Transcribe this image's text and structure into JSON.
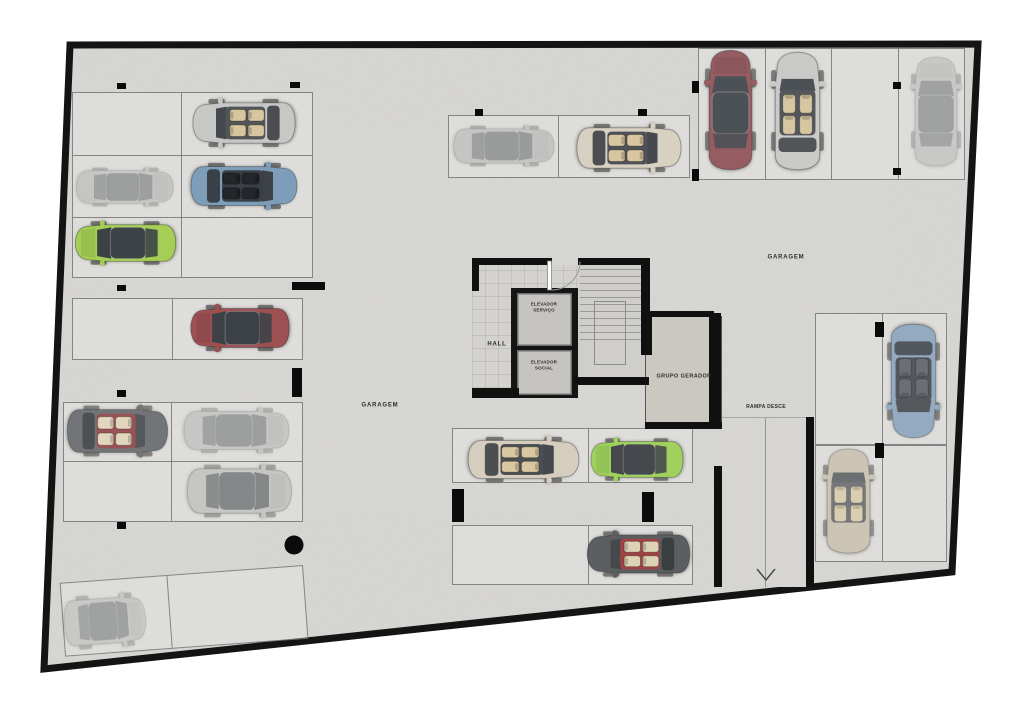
{
  "labels": {
    "hall": "HALL",
    "elevador_servico": "ELEVADOR\nSERVIÇO",
    "elevador_social": "ELEVADOR\nSOCIAL",
    "grupo_gerador": "GRUPO GERADOR",
    "rampa_desce": "RAMPA DESCE",
    "garagem_left": "GARAGEM",
    "garagem_right": "GARAGEM"
  },
  "palette": {
    "floor": "#d8d7d4",
    "outer_wall": "#141414",
    "stall_line": "#6e6e6e",
    "hall_floor": "#d3d2cf",
    "generator_room": "#cbc8c2",
    "ramp_floor": "#d6d5d2",
    "car_green": "#a4cf54",
    "car_blue": "#7d9db9",
    "car_red": "#9d5052",
    "car_maroon": "#8e4f55",
    "car_lime": "#9cd156",
    "car_silver": "#c6c6c4",
    "car_tan": "#d5cdbd"
  },
  "plan": {
    "boundary_points": "70,45 978,44 952,572 44,669",
    "stall_blocks": [
      {
        "x": 72,
        "y": 92,
        "w": 241,
        "h": 186,
        "v": [
          108
        ],
        "hl": [
          62,
          124
        ]
      },
      {
        "x": 448,
        "y": 115,
        "w": 242,
        "h": 63,
        "v": [
          109
        ]
      },
      {
        "x": 698,
        "y": 48,
        "w": 267,
        "h": 132,
        "v": [
          66,
          132,
          199
        ]
      },
      {
        "x": 72,
        "y": 298,
        "w": 231,
        "h": 62,
        "v": [
          99
        ]
      },
      {
        "x": 63,
        "y": 402,
        "w": 240,
        "h": 120,
        "v": [
          107
        ],
        "hl": [
          58
        ]
      },
      {
        "x": 59,
        "y": 565,
        "w": 244,
        "h": 74,
        "v": [
          106
        ],
        "rot": -4.2
      },
      {
        "x": 452,
        "y": 428,
        "w": 241,
        "h": 55,
        "v": [
          135
        ]
      },
      {
        "x": 452,
        "y": 525,
        "w": 241,
        "h": 60,
        "v": [
          135
        ]
      },
      {
        "x": 815,
        "y": 313,
        "w": 132,
        "h": 132,
        "v": [
          66
        ]
      },
      {
        "x": 815,
        "y": 445,
        "w": 132,
        "h": 117,
        "v": [
          66
        ]
      }
    ],
    "walls": [
      [
        472,
        258,
        80,
        7
      ],
      [
        578,
        258,
        71,
        7
      ],
      [
        472,
        258,
        7,
        33
      ],
      [
        472,
        388,
        47,
        10
      ],
      [
        573,
        377,
        76,
        8
      ],
      [
        641,
        258,
        9,
        61
      ],
      [
        641,
        313,
        11,
        42
      ],
      [
        645,
        311,
        69,
        6
      ],
      [
        709,
        313,
        12,
        111
      ],
      [
        645,
        422,
        77,
        7
      ],
      [
        714,
        466,
        8,
        121
      ],
      [
        806,
        417,
        8,
        170
      ]
    ],
    "pillars": [
      [
        117,
        83,
        9,
        6
      ],
      [
        290,
        82,
        10,
        6
      ],
      [
        475,
        109,
        8,
        7
      ],
      [
        638,
        109,
        9,
        7
      ],
      [
        692,
        81,
        7,
        12
      ],
      [
        692,
        169,
        7,
        12
      ],
      [
        893,
        82,
        8,
        7
      ],
      [
        893,
        168,
        8,
        7
      ],
      [
        292,
        282,
        33,
        8
      ],
      [
        117,
        285,
        9,
        6
      ],
      [
        292,
        368,
        10,
        29
      ],
      [
        117,
        390,
        9,
        7
      ],
      [
        117,
        522,
        9,
        7
      ],
      [
        452,
        489,
        12,
        33
      ],
      [
        642,
        492,
        12,
        30
      ],
      [
        875,
        322,
        9,
        15
      ],
      [
        875,
        443,
        9,
        15
      ]
    ],
    "round_column": {
      "cx": 294,
      "cy": 545,
      "r": 9.5
    },
    "cars": [
      {
        "x": 190,
        "y": 97,
        "w": 108,
        "hgt": 52,
        "t": "conv",
        "dir": "left",
        "body": "#c6c6c4",
        "cabin": "#4a4e52",
        "seat": "#d6c59c",
        "deck": 1,
        "op": 0.95
      },
      {
        "x": 74,
        "y": 166,
        "w": 102,
        "hgt": 42,
        "t": "sedan",
        "dir": "right",
        "body": "#a3a3a1",
        "op": 0.4
      },
      {
        "x": 188,
        "y": 161,
        "w": 112,
        "hgt": 50,
        "t": "conv",
        "dir": "right",
        "body": "#7d9db9",
        "cabin": "#3b4046",
        "seat": "#23262a",
        "deck": 1,
        "op": 1
      },
      {
        "x": 72,
        "y": 219,
        "w": 106,
        "hgt": 47,
        "t": "sedan",
        "dir": "left",
        "body": "#a4cf54",
        "op": 1
      },
      {
        "x": 188,
        "y": 303,
        "w": 104,
        "hgt": 50,
        "t": "sedan",
        "dir": "left",
        "body": "#9d5052",
        "op": 1
      },
      {
        "x": 64,
        "y": 403,
        "w": 106,
        "hgt": 55,
        "t": "conv",
        "dir": "right",
        "body": "#606366",
        "cabin": "#8e3a3e",
        "seat": "#e3d6ba",
        "deck": 1,
        "op": 0.85
      },
      {
        "x": 181,
        "y": 406,
        "w": 111,
        "hgt": 49,
        "t": "sedan",
        "dir": "right",
        "body": "#a5a5a3",
        "op": 0.4
      },
      {
        "x": 184,
        "y": 462,
        "w": 110,
        "hgt": 57,
        "t": "sedan",
        "dir": "right",
        "body": "#b3b3b1",
        "op": 0.55
      },
      {
        "x": 62,
        "y": 592,
        "w": 86,
        "hgt": 58,
        "t": "sedan",
        "dir": "right",
        "tilt": -4.2,
        "body": "#a8a8a6",
        "op": 0.38
      },
      {
        "x": 451,
        "y": 124,
        "w": 106,
        "hgt": 44,
        "t": "sedan",
        "dir": "right",
        "body": "#a5a5a3",
        "op": 0.42
      },
      {
        "x": 574,
        "y": 122,
        "w": 110,
        "hgt": 52,
        "t": "conv",
        "dir": "right",
        "body": "#d8d0c0",
        "cabin": "#474b50",
        "seat": "#d9c49c",
        "deck": 1,
        "op": 0.95
      },
      {
        "x": 703,
        "y": 47,
        "w": 55,
        "hgt": 126,
        "t": "sedan",
        "dir": "up",
        "body": "#8e4f55",
        "op": 0.9
      },
      {
        "x": 769,
        "y": 49,
        "w": 57,
        "hgt": 124,
        "t": "conv",
        "dir": "up",
        "body": "#c8c8c6",
        "cabin": "#45494e",
        "seat": "#d6c59c",
        "deck": 1,
        "op": 0.9
      },
      {
        "x": 909,
        "y": 54,
        "w": 54,
        "hgt": 115,
        "t": "sedan",
        "dir": "up",
        "body": "#a7a7a5",
        "op": 0.38
      },
      {
        "x": 885,
        "y": 321,
        "w": 57,
        "hgt": 120,
        "t": "conv",
        "dir": "down",
        "body": "#87a2bc",
        "cabin": "#3c4147",
        "seat": "#565c63",
        "deck": 1,
        "op": 0.85
      },
      {
        "x": 821,
        "y": 446,
        "w": 55,
        "hgt": 110,
        "t": "conv",
        "dir": "up",
        "body": "#c4baa4",
        "cabin": "#4a4e52",
        "seat": "#d9c8a0",
        "deck": 0,
        "op": 0.7
      },
      {
        "x": 465,
        "y": 435,
        "w": 117,
        "hgt": 49,
        "t": "conv",
        "dir": "right",
        "body": "#d5cdbd",
        "cabin": "#43474c",
        "seat": "#d8c69e",
        "deck": 1,
        "op": 0.95
      },
      {
        "x": 588,
        "y": 436,
        "w": 97,
        "hgt": 46,
        "t": "sedan",
        "dir": "left",
        "body": "#9cd156",
        "op": 0.95
      },
      {
        "x": 584,
        "y": 529,
        "w": 108,
        "hgt": 49,
        "t": "conv",
        "dir": "left",
        "body": "#55585b",
        "cabin": "#9c3a3e",
        "seat": "#ded2b4",
        "deck": 1,
        "op": 0.95
      }
    ]
  }
}
